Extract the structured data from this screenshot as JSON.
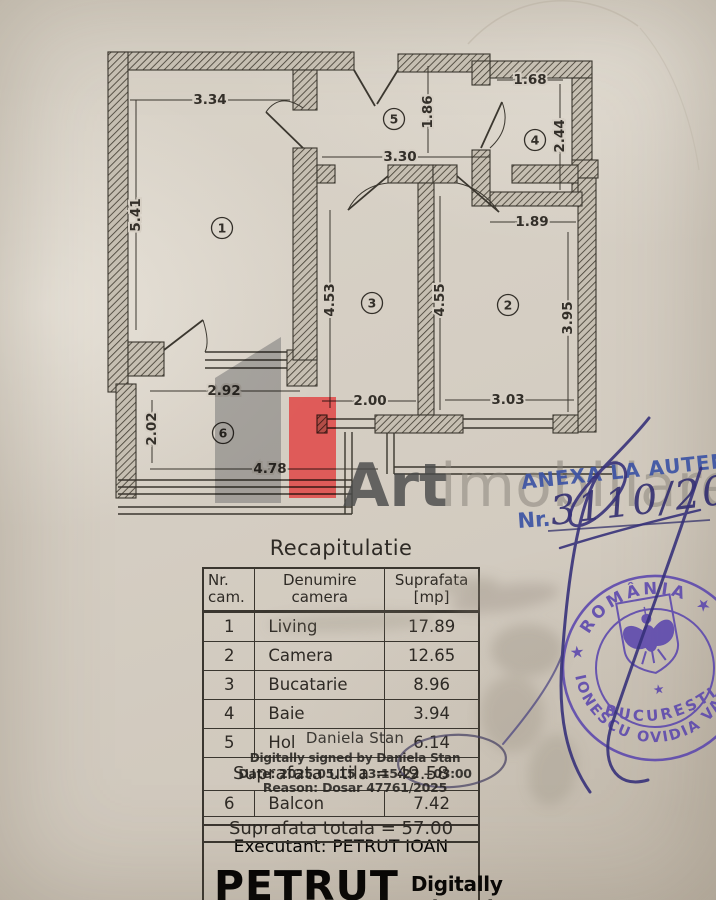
{
  "plan": {
    "dims": [
      {
        "label": "3.34"
      },
      {
        "label": "5.41"
      },
      {
        "label": "1.86"
      },
      {
        "label": "3.30"
      },
      {
        "label": "1.68"
      },
      {
        "label": "2.44"
      },
      {
        "label": "1.89"
      },
      {
        "label": "4.53"
      },
      {
        "label": "4.55"
      },
      {
        "label": "3.95"
      },
      {
        "label": "2.00"
      },
      {
        "label": "3.03"
      },
      {
        "label": "2.92"
      },
      {
        "label": "2.02"
      },
      {
        "label": "4.78"
      }
    ],
    "rooms": [
      {
        "num": "1"
      },
      {
        "num": "2"
      },
      {
        "num": "3"
      },
      {
        "num": "4"
      },
      {
        "num": "5"
      },
      {
        "num": "6"
      }
    ]
  },
  "watermark": {
    "word1": "Art",
    "word2": "imobiliare"
  },
  "annex_stamp": {
    "title": "ANEXA LA AUTENTIF",
    "nr_label": "Nr.",
    "handwritten_number": "3110/2025"
  },
  "notary_stamp": {
    "country_arc": "★ ROMÂNIA ★",
    "name_arc": "IONESCU OVIDIA VANINA ★ NOT",
    "city": "BUCUREŞTI",
    "star": "★"
  },
  "table": {
    "title": "Recapitulatie",
    "headers": {
      "c1l1": "Nr.",
      "c1l2": "cam.",
      "c2l1": "Denumire",
      "c2l2": "camera",
      "c3l1": "Suprafata",
      "c3l2": "[mp]"
    },
    "rows": [
      {
        "num": "1",
        "name": "Living",
        "area": "17.89"
      },
      {
        "num": "2",
        "name": "Camera",
        "area": "12.65"
      },
      {
        "num": "3",
        "name": "Bucatarie",
        "area": "8.96"
      },
      {
        "num": "4",
        "name": "Baie",
        "area": "3.94"
      },
      {
        "num": "5",
        "name": "Hol",
        "area": "6.14"
      }
    ],
    "subtotal": "Suprafata utila = 49.58",
    "row6": {
      "num": "6",
      "name": "Balcon",
      "area": "7.42"
    },
    "total": "Suprafata totala = 57.00",
    "executant": "Executant: PETRUT IOAN",
    "signer_name": "PETRUT",
    "signed_note": "Digitally signed"
  },
  "digital_signature": {
    "name": "Daniela Stan",
    "line2": "Digitally signed by Daniela Stan",
    "line3": "Date: 2025.05.15 13:15:22 +03:00",
    "line4": "Reason: Dosar 47761/2025"
  }
}
